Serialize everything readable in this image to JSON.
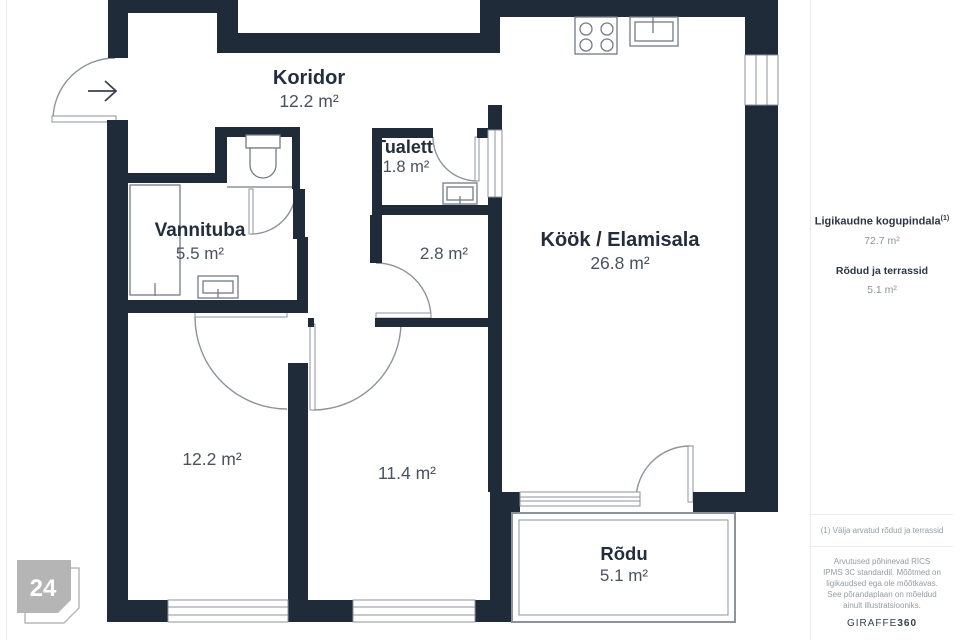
{
  "plan": {
    "rooms": {
      "koridor": {
        "name": "Koridor",
        "area": "12.2 m²"
      },
      "tualett": {
        "name": "Tualett",
        "area": "1.8 m²"
      },
      "vannituba": {
        "name": "Vannituba",
        "area": "5.5 m²"
      },
      "hall": {
        "area": "2.8 m²"
      },
      "kook_elamisala": {
        "name": "Köök / Elamisala",
        "area": "26.8 m²"
      },
      "magamistuba1": {
        "area": "12.2 m²"
      },
      "magamistuba2": {
        "area": "11.4 m²"
      },
      "rodu": {
        "name": "Rõdu",
        "area": "5.1 m²"
      }
    }
  },
  "badge": {
    "number": "24"
  },
  "sidebar": {
    "total_label": "Ligikaudne kogupindala",
    "total_sup": "(1)",
    "total_value": "72.7 m²",
    "balcony_label": "Rõdud ja terrassid",
    "balcony_value": "5.1 m²",
    "footnote": "(1) Välja arvatud rõdud ja terrassid",
    "disclaimer": "Arvutused põhinevad RICS IPMS 3C standardil. Mõõtmed on ligikaudsed ega ole mõõtkavas. See põrandaplaan on mõeldud ainult illustratsiooniks.",
    "brand_name": "GIRAFFE",
    "brand_number": "360"
  },
  "colors": {
    "wall": "#202b39",
    "thin_line": "#8d939b",
    "fixture": "#737b85",
    "badge": "#b5b5b5"
  }
}
